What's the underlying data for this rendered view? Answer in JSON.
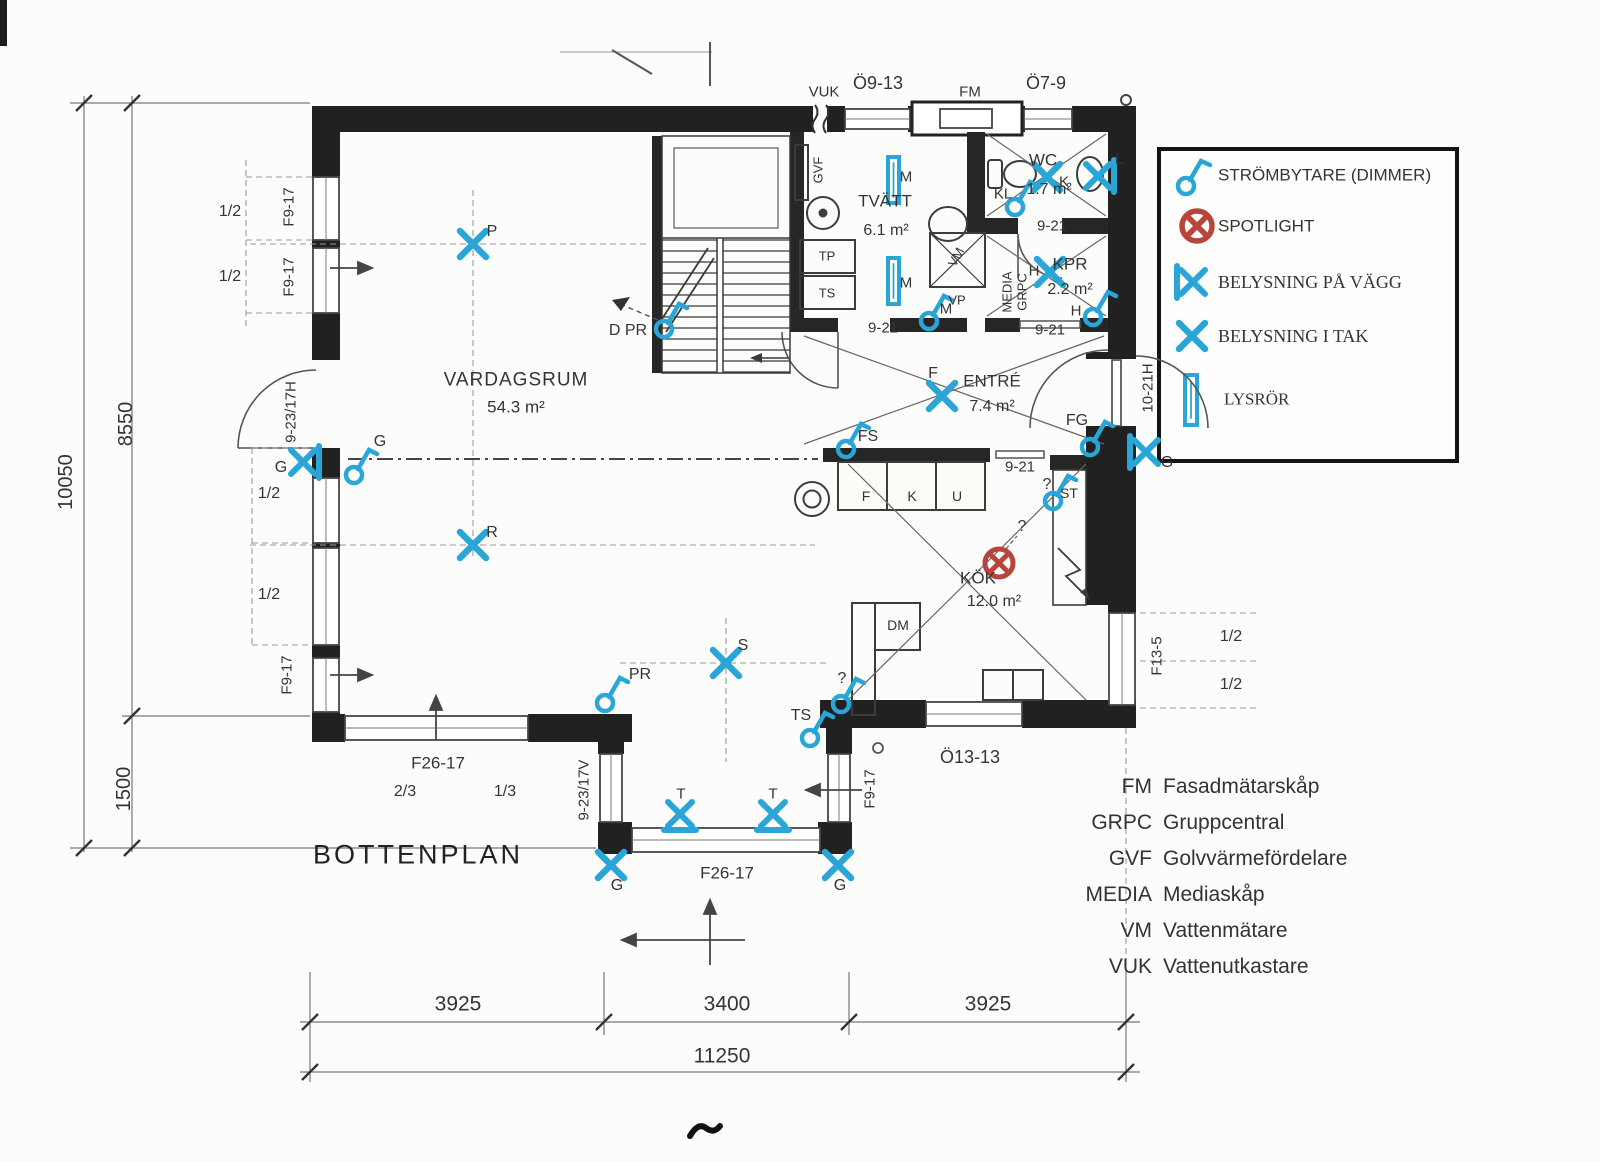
{
  "title": "BOTTENPLAN",
  "legend": {
    "items": [
      {
        "icon": "dimmer-switch-icon",
        "label": "STRÖMBYTARE  (DIMMER)"
      },
      {
        "icon": "spotlight-icon",
        "label": "SPOTLIGHT"
      },
      {
        "icon": "wall-light-icon",
        "label": "BELYSNING PÅ VÄGG"
      },
      {
        "icon": "ceiling-light-icon",
        "label": "BELYSNING I TAK"
      },
      {
        "icon": "fluorescent-tube-icon",
        "label": "LYSRÖR"
      }
    ]
  },
  "abbreviations": [
    {
      "abbr": "FM",
      "meaning": "Fasadmätarskåp"
    },
    {
      "abbr": "GRPC",
      "meaning": "Gruppcentral"
    },
    {
      "abbr": "GVF",
      "meaning": "Golvvärmefördelare"
    },
    {
      "abbr": "MEDIA",
      "meaning": "Mediaskåp"
    },
    {
      "abbr": "VM",
      "meaning": "Vattenmätare"
    },
    {
      "abbr": "VUK",
      "meaning": "Vattenutkastare"
    }
  ],
  "rooms": {
    "vardagsrum": {
      "name": "VARDAGSRUM",
      "area": "54.3 m²"
    },
    "tvatt": {
      "name": "TVÄTT",
      "area": "6.1 m²"
    },
    "wc": {
      "name": "WC",
      "area": "1.7 m²"
    },
    "kpr": {
      "name": "KPR",
      "area": "2.2 m²"
    },
    "entre": {
      "name": "ENTRÉ",
      "area": "7.4 m²"
    },
    "kok": {
      "name": "KÖK",
      "area": "12.0 m²"
    }
  },
  "openings": {
    "o913": "Ö9-13",
    "o79": "Ö7-9",
    "o1313": "Ö13-13",
    "f917": "F9-17",
    "f2617": "F26-17",
    "f135": "F13-5",
    "d923_17h": "9-23/17H",
    "d923_17v": "9-23/17V",
    "d1021h": "10-21H",
    "w921": "9-21"
  },
  "fixtures": {
    "vuk": "VUK",
    "fm": "FM",
    "gvf": "GVF",
    "tp": "TP",
    "ts": "TS",
    "vm": "VM",
    "vp": "VP",
    "media": "MEDIA",
    "grpc": "GRPC",
    "dm": "DM",
    "st": "ST"
  },
  "cabinet": {
    "f": "F",
    "k": "K",
    "u": "U"
  },
  "lights": {
    "p": "P",
    "r": "R",
    "s": "S",
    "f": "F",
    "k": "K",
    "h": "H",
    "l": "L",
    "g": "G",
    "t": "T",
    "m": "M"
  },
  "switches": {
    "d_pr": "D PR",
    "pr": "PR",
    "g": "G",
    "kl": "KL",
    "m": "M",
    "h": "H",
    "fs": "FS",
    "fg": "FG",
    "ts": "TS",
    "unknown": "?"
  },
  "dimensions": {
    "total_width": "11250",
    "bottom_segments": [
      "3925",
      "3400",
      "3925"
    ],
    "total_height": "10050",
    "left_upper": "8550",
    "left_lower": "1500",
    "half": "1/2",
    "two_thirds": "2/3",
    "one_third": "1/3"
  }
}
